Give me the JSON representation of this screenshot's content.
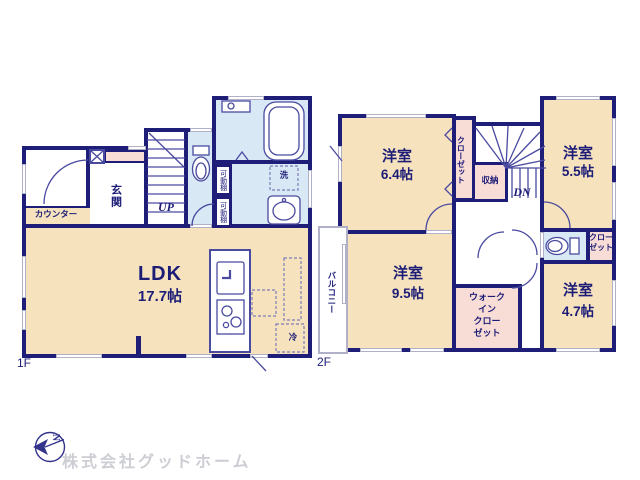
{
  "floor1": {
    "label": "1F",
    "ldk_name": "LDK",
    "ldk_size": "17.7帖",
    "genkan": "玄関",
    "counter": "カウンター",
    "stairs_dir": "UP",
    "shelf1": "可動棚",
    "shelf2": "可動棚",
    "laundry": "洗",
    "fridge": "冷"
  },
  "floor2": {
    "label": "2F",
    "room64_name": "洋室",
    "room64_size": "6.4帖",
    "room55_name": "洋室",
    "room55_size": "5.5帖",
    "room95_name": "洋室",
    "room95_size": "9.5帖",
    "room47_name": "洋室",
    "room47_size": "4.7帖",
    "closet1": "クローゼット",
    "storage": "収納",
    "stairs_dir": "DN",
    "closet2": [
      "クロー",
      "ゼット"
    ],
    "wic": [
      "ウォーク",
      "イン",
      "クロー",
      "ゼット"
    ],
    "balcony": "バルコニー"
  },
  "footer": {
    "company": "株式会社グッドホーム",
    "compass_letter": "N"
  },
  "colors": {
    "wall": "#1e1e78",
    "room_tan": "#f6e3bd",
    "closet_pink": "#f8dcd6",
    "wet_blue": "#d9e8f5",
    "footer_text": "#cdced4"
  }
}
